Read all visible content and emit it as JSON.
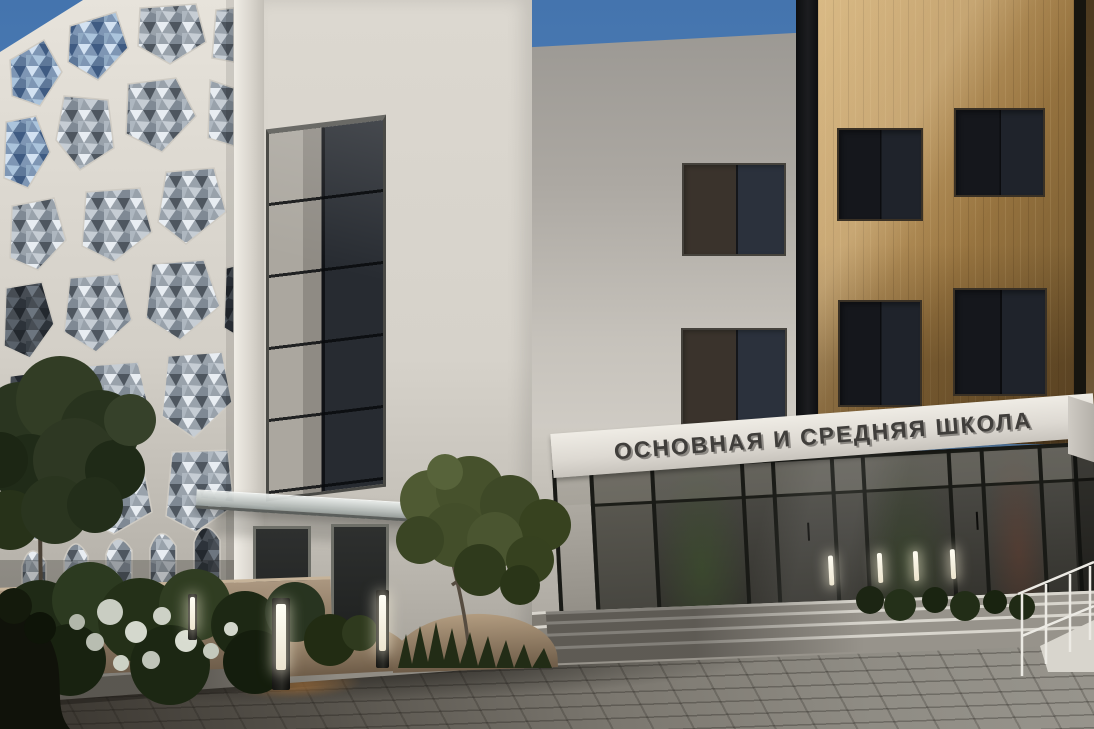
{
  "sign": {
    "text": "ОСНОВНАЯ И СРЕДНЯЯ ШКОЛА",
    "text_color": "#403e3b",
    "band_color": "#e7e3dc"
  },
  "palette": {
    "sky": "#4a7ab2",
    "wood_facade": "#a07c48",
    "white_facade": "#d9d5cd",
    "perforated_panel": "#e3dfd7",
    "metal_infill": "#99a2ab",
    "dark_glass": "#23262b",
    "pavement": "#807c74",
    "foliage": "#31401f",
    "led_light": "#fdf8e8"
  }
}
